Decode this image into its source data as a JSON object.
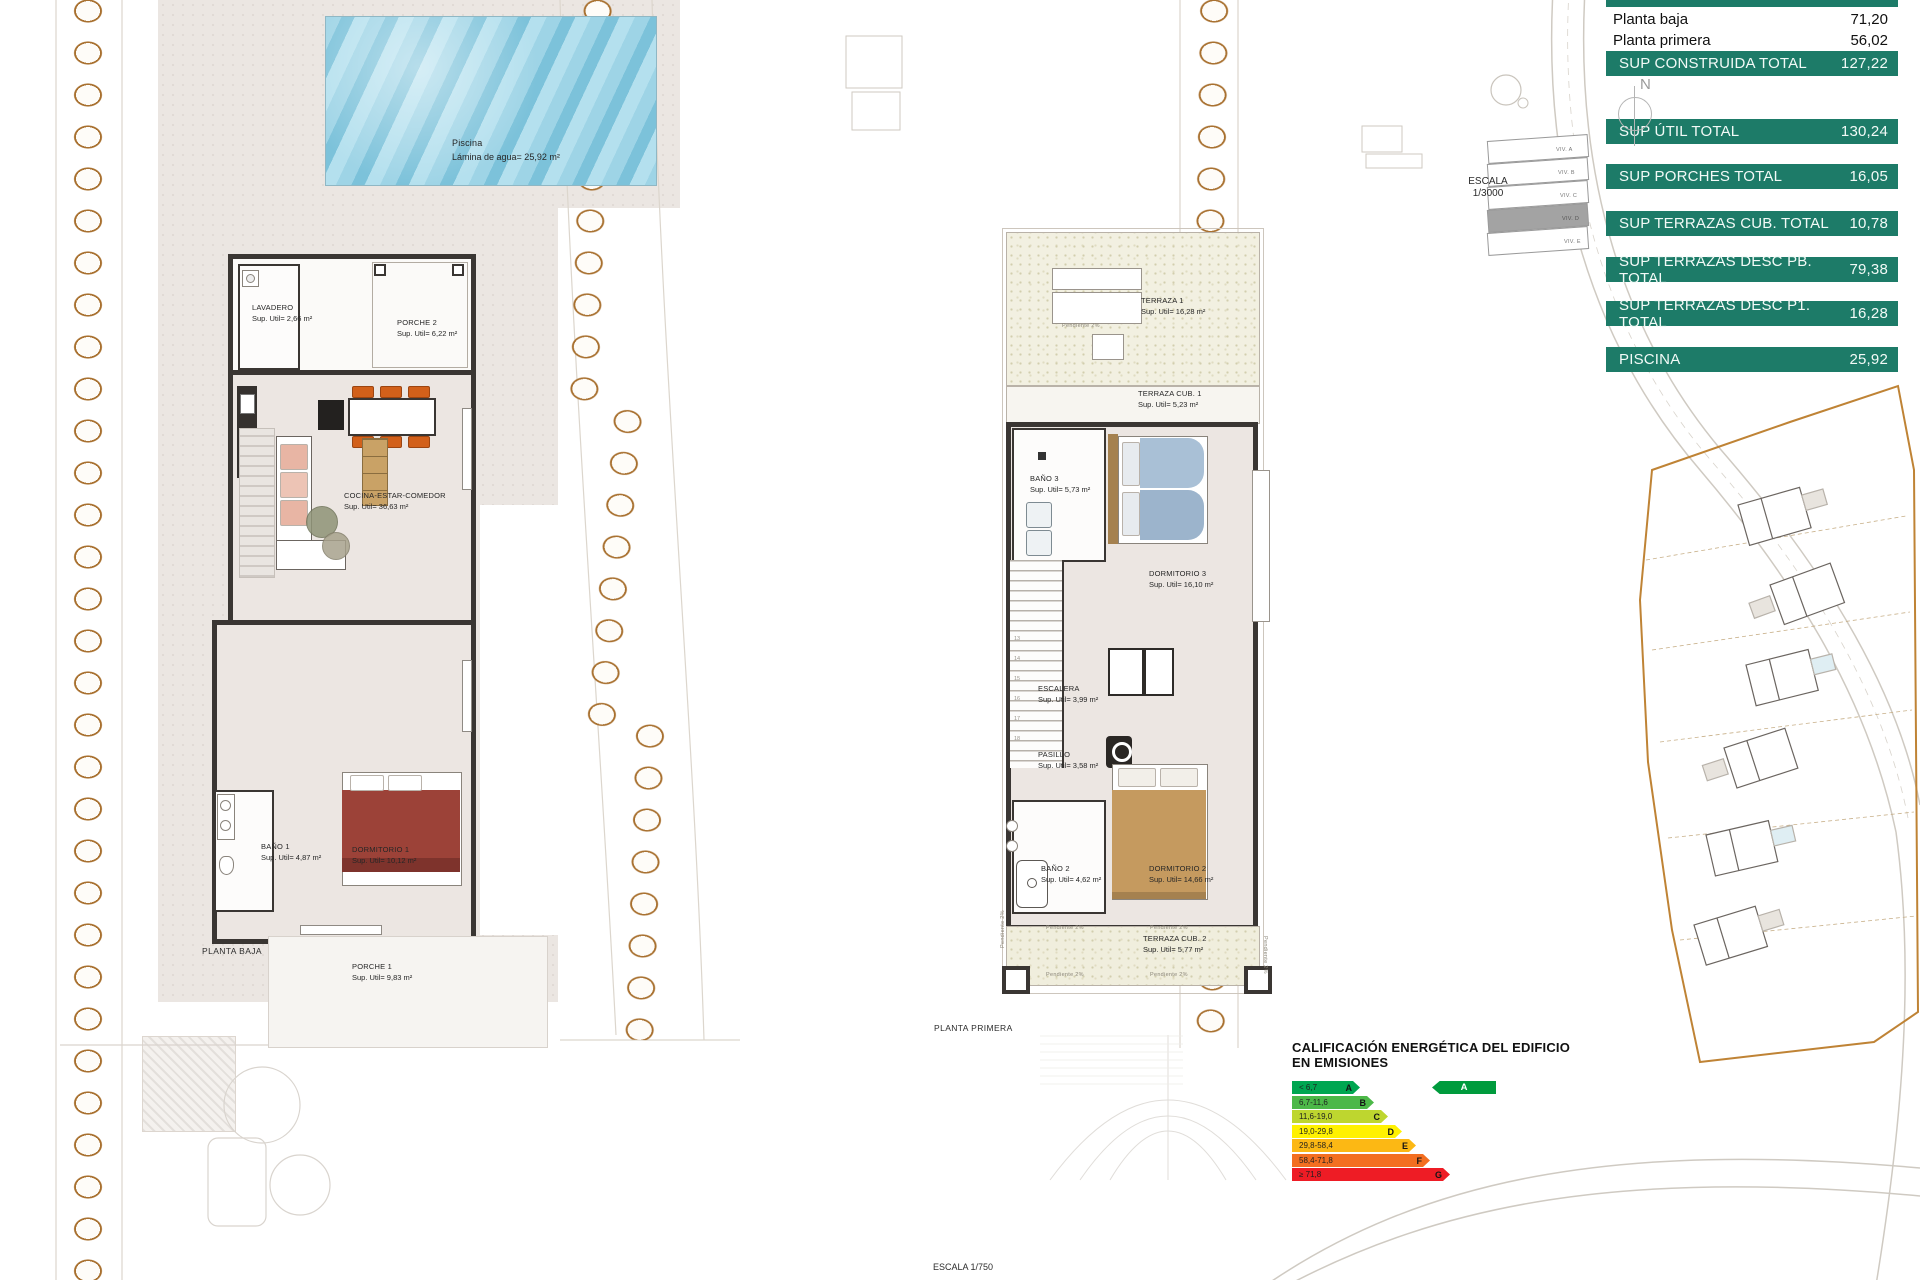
{
  "summary_table": {
    "header_label": "SUP CONSTRUIDA",
    "rows": [
      {
        "label": "Planta baja",
        "value": "71,20"
      },
      {
        "label": "Planta primera",
        "value": "56,02"
      },
      {
        "label": "SUP CONSTRUIDA TOTAL",
        "value": "127,22"
      },
      {
        "label": "SUP ÚTIL TOTAL",
        "value": "130,24"
      },
      {
        "label": "SUP PORCHES TOTAL",
        "value": "16,05"
      },
      {
        "label": "SUP TERRAZAS CUB. TOTAL",
        "value": "10,78"
      },
      {
        "label": "SUP TERRAZAS DESC PB. TOTAL",
        "value": "79,38"
      },
      {
        "label": "SUP TERRAZAS DESC P1. TOTAL",
        "value": "16,28"
      },
      {
        "label": "PISCINA",
        "value": "25,92"
      }
    ],
    "green_color": "#1d7b68"
  },
  "planta_baja": {
    "title": "PLANTA BAJA",
    "pool": {
      "name": "Piscina",
      "area": "Lámina de agua= 25,92 m²"
    },
    "rooms": {
      "lavadero": {
        "name": "LAVADERO",
        "area": "Sup. Util= 2,66 m²"
      },
      "porche2": {
        "name": "PORCHE 2",
        "area": "Sup. Util= 6,22 m²"
      },
      "cocina": {
        "name": "COCINA-ESTAR-COMEDOR",
        "area": "Sup. Util= 36,63 m²"
      },
      "bano1": {
        "name": "BAÑO 1",
        "area": "Sup. Util= 4,87 m²"
      },
      "dormitorio1": {
        "name": "DORMITORIO 1",
        "area": "Sup. Util= 10,12 m²"
      },
      "porche1": {
        "name": "PORCHE 1",
        "area": "Sup. Util= 9,83 m²"
      }
    }
  },
  "planta_primera": {
    "title": "PLANTA PRIMERA",
    "slope_note": "Pendiente 2%",
    "stair_numbers": [
      "13",
      "14",
      "15",
      "16",
      "17",
      "18"
    ],
    "rooms": {
      "terraza1": {
        "name": "TERRAZA  1",
        "area": "Sup. Util= 16,28 m²"
      },
      "terrazacub1": {
        "name": "TERRAZA CUB.  1",
        "area": "Sup. Util= 5,23 m²"
      },
      "bano3": {
        "name": "BAÑO 3",
        "area": "Sup. Util= 5,73 m²"
      },
      "dormitorio3": {
        "name": "DORMITORIO 3",
        "area": "Sup. Util= 16,10 m²"
      },
      "escalera": {
        "name": "ESCALERA",
        "area": "Sup. Util= 3,99 m²"
      },
      "pasillo": {
        "name": "PASILLO",
        "area": "Sup. Util= 3,58 m²"
      },
      "bano2": {
        "name": "BAÑO 2",
        "area": "Sup. Util= 4,62 m²"
      },
      "dormitorio2": {
        "name": "DORMITORIO 2",
        "area": "Sup. Util= 14,66 m²"
      },
      "terrazacub2": {
        "name": "TERRAZA CUB.  2",
        "area": "Sup. Util= 5,77 m²"
      }
    }
  },
  "site_plan": {
    "escala_line1": "ESCALA",
    "escala_line2": "1/3000",
    "north_label": "N",
    "viv_labels": [
      "VIV. A",
      "VIV. B",
      "VIV. C",
      "VIV. D",
      "VIV. E"
    ]
  },
  "energy_rating": {
    "title_line1": "CALIFICACIÓN ENERGÉTICA DEL EDIFICIO",
    "title_line2": "EN EMISIONES",
    "bands": [
      {
        "range": "< 6,7",
        "letter": "A",
        "color": "#00a651"
      },
      {
        "range": "6,7-11,6",
        "letter": "B",
        "color": "#4cb848"
      },
      {
        "range": "11,6-19,0",
        "letter": "C",
        "color": "#bed62f"
      },
      {
        "range": "19,0-29,8",
        "letter": "D",
        "color": "#fff101"
      },
      {
        "range": "29,8-58,4",
        "letter": "E",
        "color": "#fcb814"
      },
      {
        "range": "58,4-71,8",
        "letter": "F",
        "color": "#f36f21"
      },
      {
        "range": "≥ 71,8",
        "letter": "G",
        "color": "#ee1c25"
      }
    ],
    "rating": {
      "letter": "A",
      "color": "#009b3d"
    }
  },
  "footer": {
    "escala": "ESCALA   1/750"
  },
  "colors": {
    "table_green": "#1d7b68",
    "wall": "#3a3633",
    "room_floor": "#ece6e2",
    "terrace": "#f2f0e1",
    "pool_blue": "#8fcbe0",
    "chair_orange": "#d2601a",
    "bed_red": "#9c4238",
    "bed_blue": "#a9c0d6",
    "bed_tan": "#c59a5f",
    "rock_brown": "#a8702f"
  }
}
